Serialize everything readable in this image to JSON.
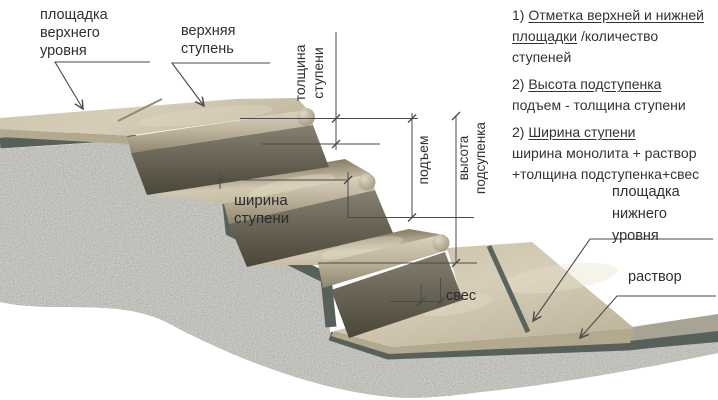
{
  "callouts": {
    "upper_platform": [
      "площадка",
      "верхнего",
      "уровня"
    ],
    "upper_step": [
      "верхняя",
      "ступень"
    ],
    "lower_platform": [
      "площадка",
      "нижнего",
      "уровня"
    ],
    "mortar": "раствор"
  },
  "dimensions": {
    "tread_thickness": [
      "толщина",
      "ступени"
    ],
    "rise": "подъем",
    "riser_height": [
      "высота",
      "подсупенка"
    ],
    "step_width": "ширина ступени",
    "overhang": "свес"
  },
  "notes": {
    "item1_prefix": "1) ",
    "item1_underlined": "Отметка верхней и нижней",
    "item1_line2_underlined": "площадки",
    "item1_line2_rest": " /количество ступеней",
    "item2_prefix": "2) ",
    "item2_underlined": "Высота подступенка",
    "item2_line2": "подъем - толщина ступени",
    "item3_prefix": "2) ",
    "item3_underlined": "Ширина ступени",
    "item3_line2": "ширина монолита + раствор",
    "item3_line3": "+толщина подступенка+свес"
  },
  "colors": {
    "slab_beige": "#cfc5ae",
    "slab_highlight": "#d8cfba",
    "riser_dark": "#55503f",
    "mortar_green_gray": "#57605a",
    "granite_gray": "#8d8e88",
    "dimension_line": "#4a4a4a",
    "text": "#2f2f2f",
    "background": "#ffffff"
  }
}
